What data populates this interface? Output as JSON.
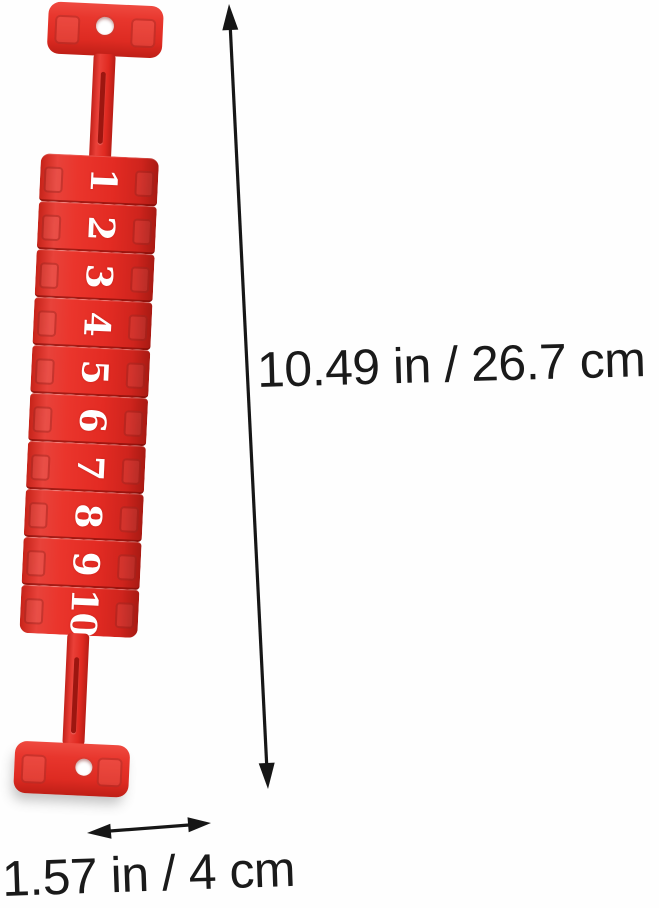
{
  "product": {
    "name": "red foosball score counter",
    "bead_numbers": [
      "1",
      "2",
      "3",
      "4",
      "5",
      "6",
      "7",
      "8",
      "9",
      "10"
    ],
    "colors": {
      "red": "#e32b23",
      "red_light": "#ef4a40",
      "red_dark": "#b81d16",
      "number_color": "#ffffff",
      "annotation_color": "#1a1a1a",
      "background": "#fefefe"
    }
  },
  "dimensions": {
    "height_label": "10.49 in / 26.7 cm",
    "width_label": "1.57 in / 4 cm"
  }
}
